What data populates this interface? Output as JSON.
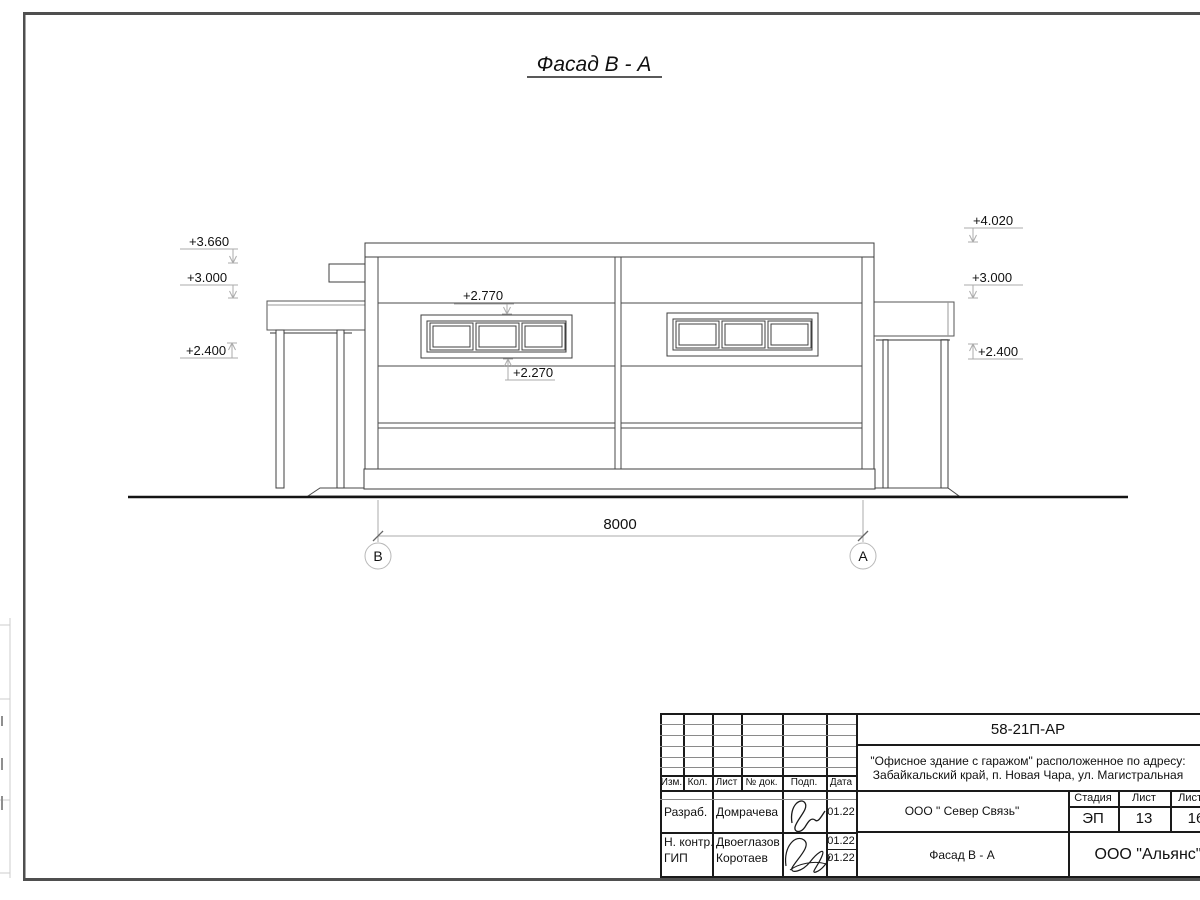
{
  "sheet": {
    "title": "Фасад В - А"
  },
  "colors": {
    "ink": "#1a1a1a",
    "frame_gray": "#4f4f4f",
    "dim_gray": "#ababab"
  },
  "drawing": {
    "marks_left": [
      "+3.660",
      "+3.000",
      "+2.400"
    ],
    "marks_right": [
      "+4.020",
      "+3.000",
      "+2.400"
    ],
    "window_marks": {
      "top": "+2.770",
      "bottom": "+2.270"
    },
    "dim_total": "8000",
    "axis_left": "В",
    "axis_right": "А"
  },
  "title_block": {
    "doc_number": "58-21П-АР",
    "address_line1": "\"Офисное здание с гаражом\" расположенное по адресу:",
    "address_line2": "Забайкальский край, п. Новая Чара, ул. Магистральная",
    "header": {
      "izm": "Изм.",
      "kol": "Кол.",
      "list": "Лист",
      "doc": "№ док.",
      "podp": "Подп.",
      "data": "Дата"
    },
    "rows": [
      {
        "role": "Разраб.",
        "name": "Домрачева",
        "date": "01.22"
      },
      {
        "role": "Н. контр.",
        "name": "Двоеглазов",
        "date": "01.22"
      },
      {
        "role": "ГИП",
        "name": "Коротаев",
        "date": "01.22"
      }
    ],
    "company": "ООО \" Север Связь\"",
    "view_name": "Фасад В - А",
    "stage_label": "Стадия",
    "sheet_label": "Лист",
    "sheets_label": "Листов",
    "stage": "ЭП",
    "sheet_no": "13",
    "sheets_total": "16",
    "org": "ООО \"Альянс\""
  }
}
